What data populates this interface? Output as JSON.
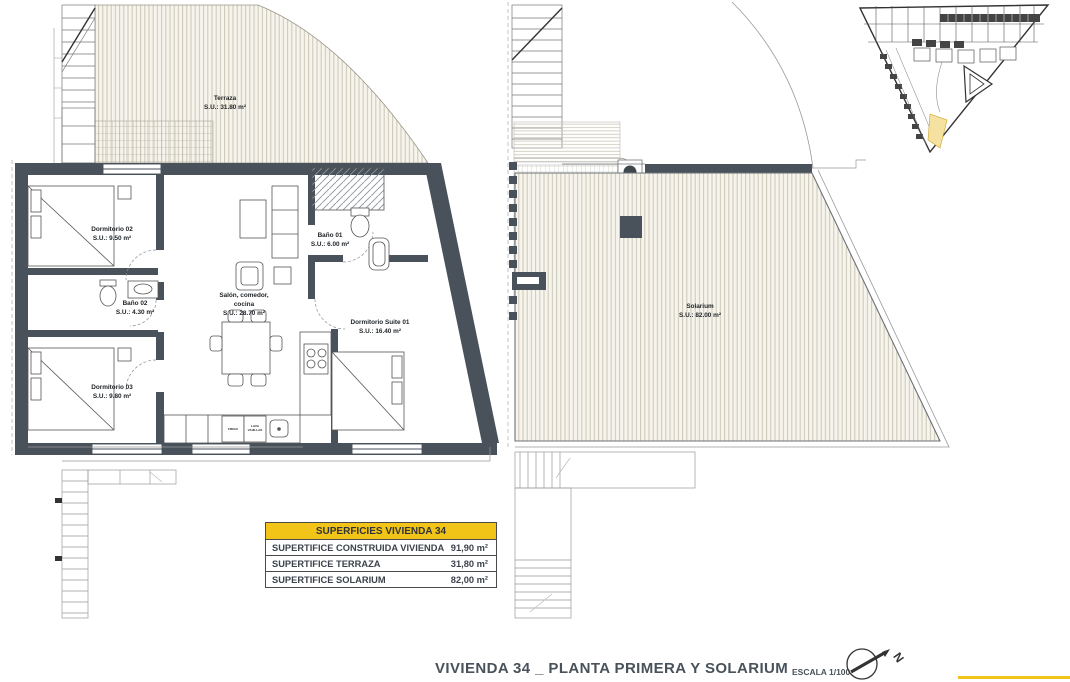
{
  "sheet": {
    "title": "VIVIENDA 34 _ PLANTA PRIMERA Y SOLARIUM",
    "scale": "ESCALA 1/100",
    "compass_letter": "N"
  },
  "plans": {
    "left": {
      "terraza": {
        "name": "Terraza",
        "area": "S.U.: 31.80 m²"
      },
      "dormitorio02": {
        "name": "Dormitorio 02",
        "area": "S.U.: 9.50 m²"
      },
      "bano02": {
        "name": "Baño 02",
        "area": "S.U.: 4.30 m²"
      },
      "dormitorio03": {
        "name": "Dormitorio 03",
        "area": "S.U.: 9.80 m²"
      },
      "salon": {
        "line1": "Salón, comedor,",
        "line2": "cocina",
        "area": "S.U.: 28.70 m²"
      },
      "bano01": {
        "name": "Baño 01",
        "area": "S.U.: 6.00 m²"
      },
      "suite": {
        "name": "Dormitorio Suite 01",
        "area": "S.U.: 16.40 m²"
      },
      "kitchen": {
        "frigo": "FRIGO",
        "lava1": "LAVA",
        "lava2": "VAJILLAS"
      }
    },
    "right": {
      "solarium": {
        "name": "Solarium",
        "area": "S.U.: 82.00 m²"
      }
    }
  },
  "summary_table": {
    "header": "SUPERFICIES VIVIENDA 34",
    "rows": [
      {
        "label": "SUPERTIFICE CONSTRUIDA VIVIENDA",
        "value": "91,90 m²"
      },
      {
        "label": "SUPERTIFICE TERRAZA",
        "value": "31,80 m²"
      },
      {
        "label": "SUPERTIFICE SOLARIUM",
        "value": "82,00 m²"
      }
    ]
  },
  "colors": {
    "wall": "#49525a",
    "accent_yellow": "#f2c417",
    "site_highlight": "#f5e2a0",
    "hatch_line": "#cbc7b5",
    "title_text": "#49525a"
  }
}
